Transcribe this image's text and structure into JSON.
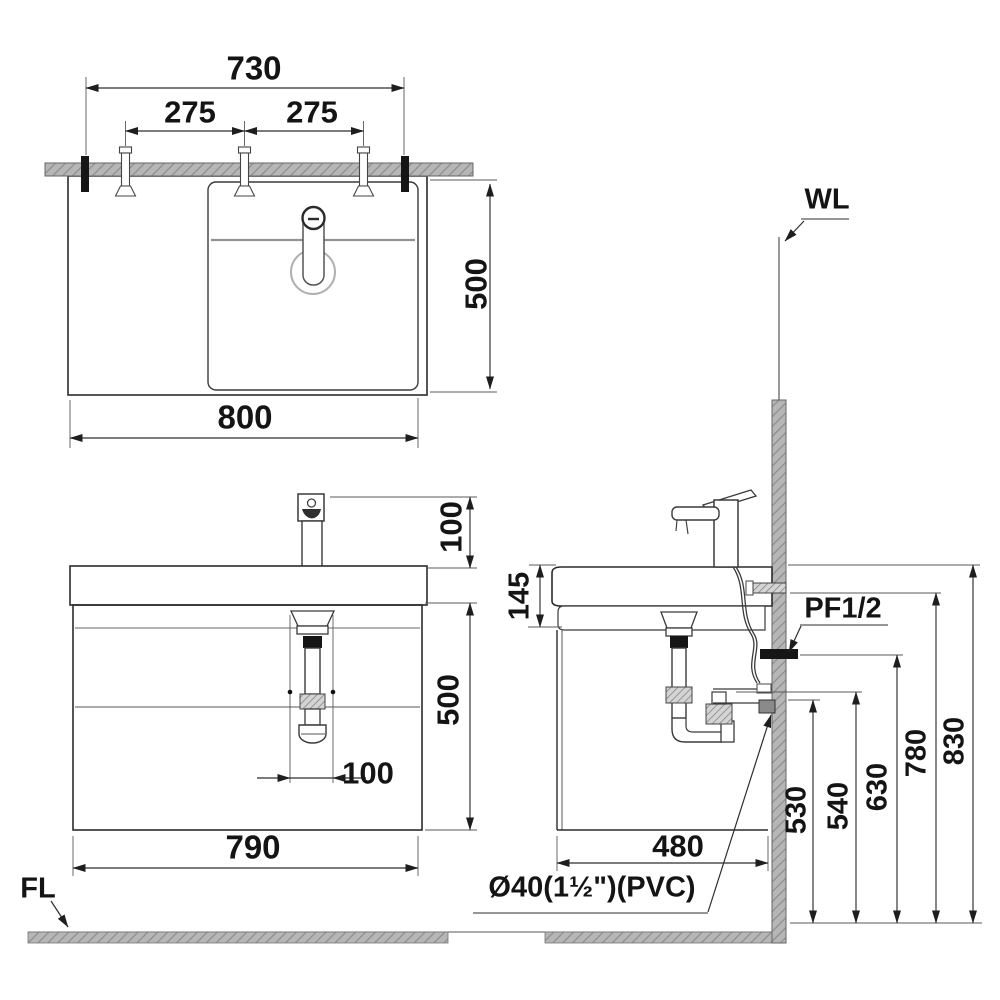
{
  "drawing": {
    "title_hint": "washbasin-vanity-installation-diagram",
    "top_view": {
      "dim_730": "730",
      "dim_275_left": "275",
      "dim_275_right": "275",
      "dim_500": "500",
      "dim_800": "800"
    },
    "front_view": {
      "dim_100_faucet": "100",
      "dim_500": "500",
      "dim_100_drain": "100",
      "dim_790": "790",
      "floor_line": "FL"
    },
    "side_view": {
      "wall_line": "WL",
      "dim_145": "145",
      "supply_fitting": "PF1/2",
      "dim_530": "530",
      "dim_540": "540",
      "dim_630": "630",
      "dim_780": "780",
      "dim_830": "830",
      "dim_480": "480",
      "drain_pipe": "Ø40(1½\")(PVC)"
    }
  },
  "colors": {
    "line": "#2b2b2b",
    "hatch_fill": "#b6b6b6",
    "hatch_stroke": "#8d8d8d",
    "background": "#ffffff"
  }
}
